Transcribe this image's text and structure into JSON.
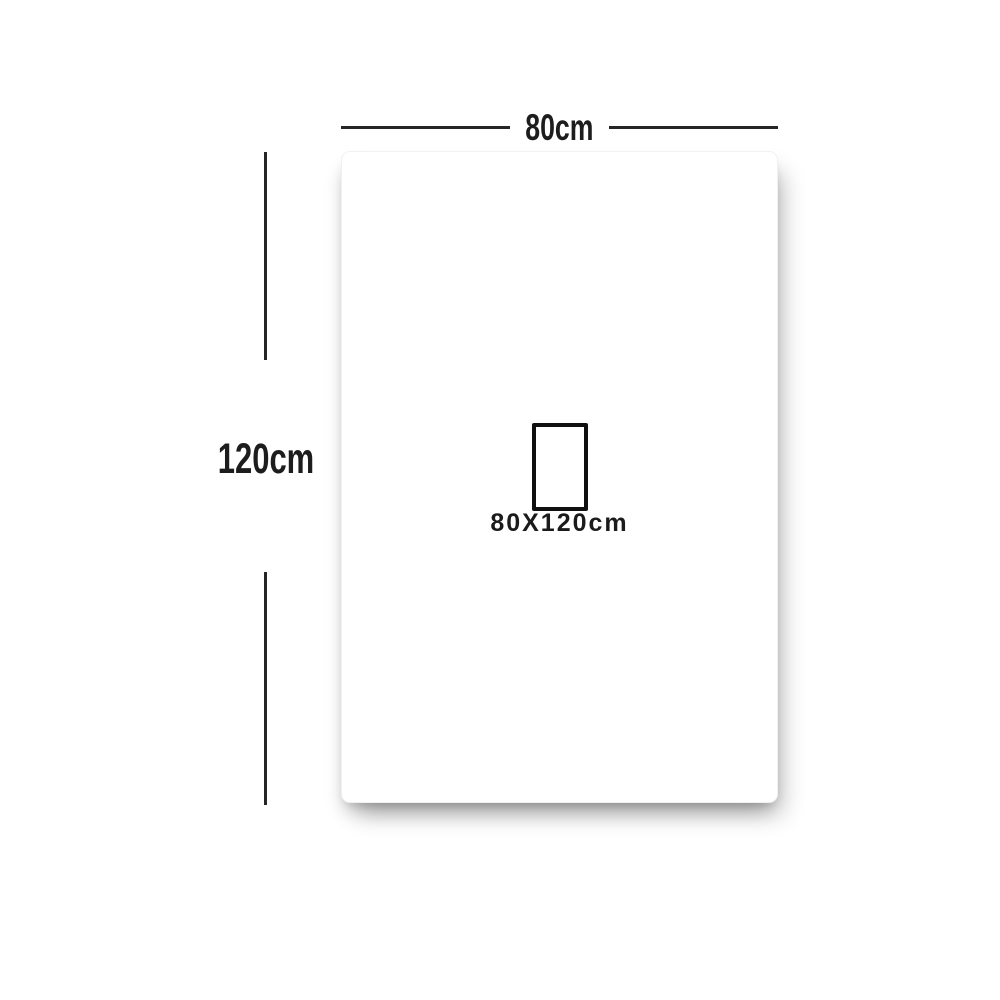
{
  "diagram": {
    "width_label": "80cm",
    "height_label": "120cm",
    "size_label": "80X120cm"
  },
  "colors": {
    "background": "#ffffff",
    "sheet": "#ffffff",
    "line": "#262626",
    "text": "#1d1d1d",
    "size_box_border": "#101010",
    "shadow": "rgba(0,0,0,0.30)"
  }
}
